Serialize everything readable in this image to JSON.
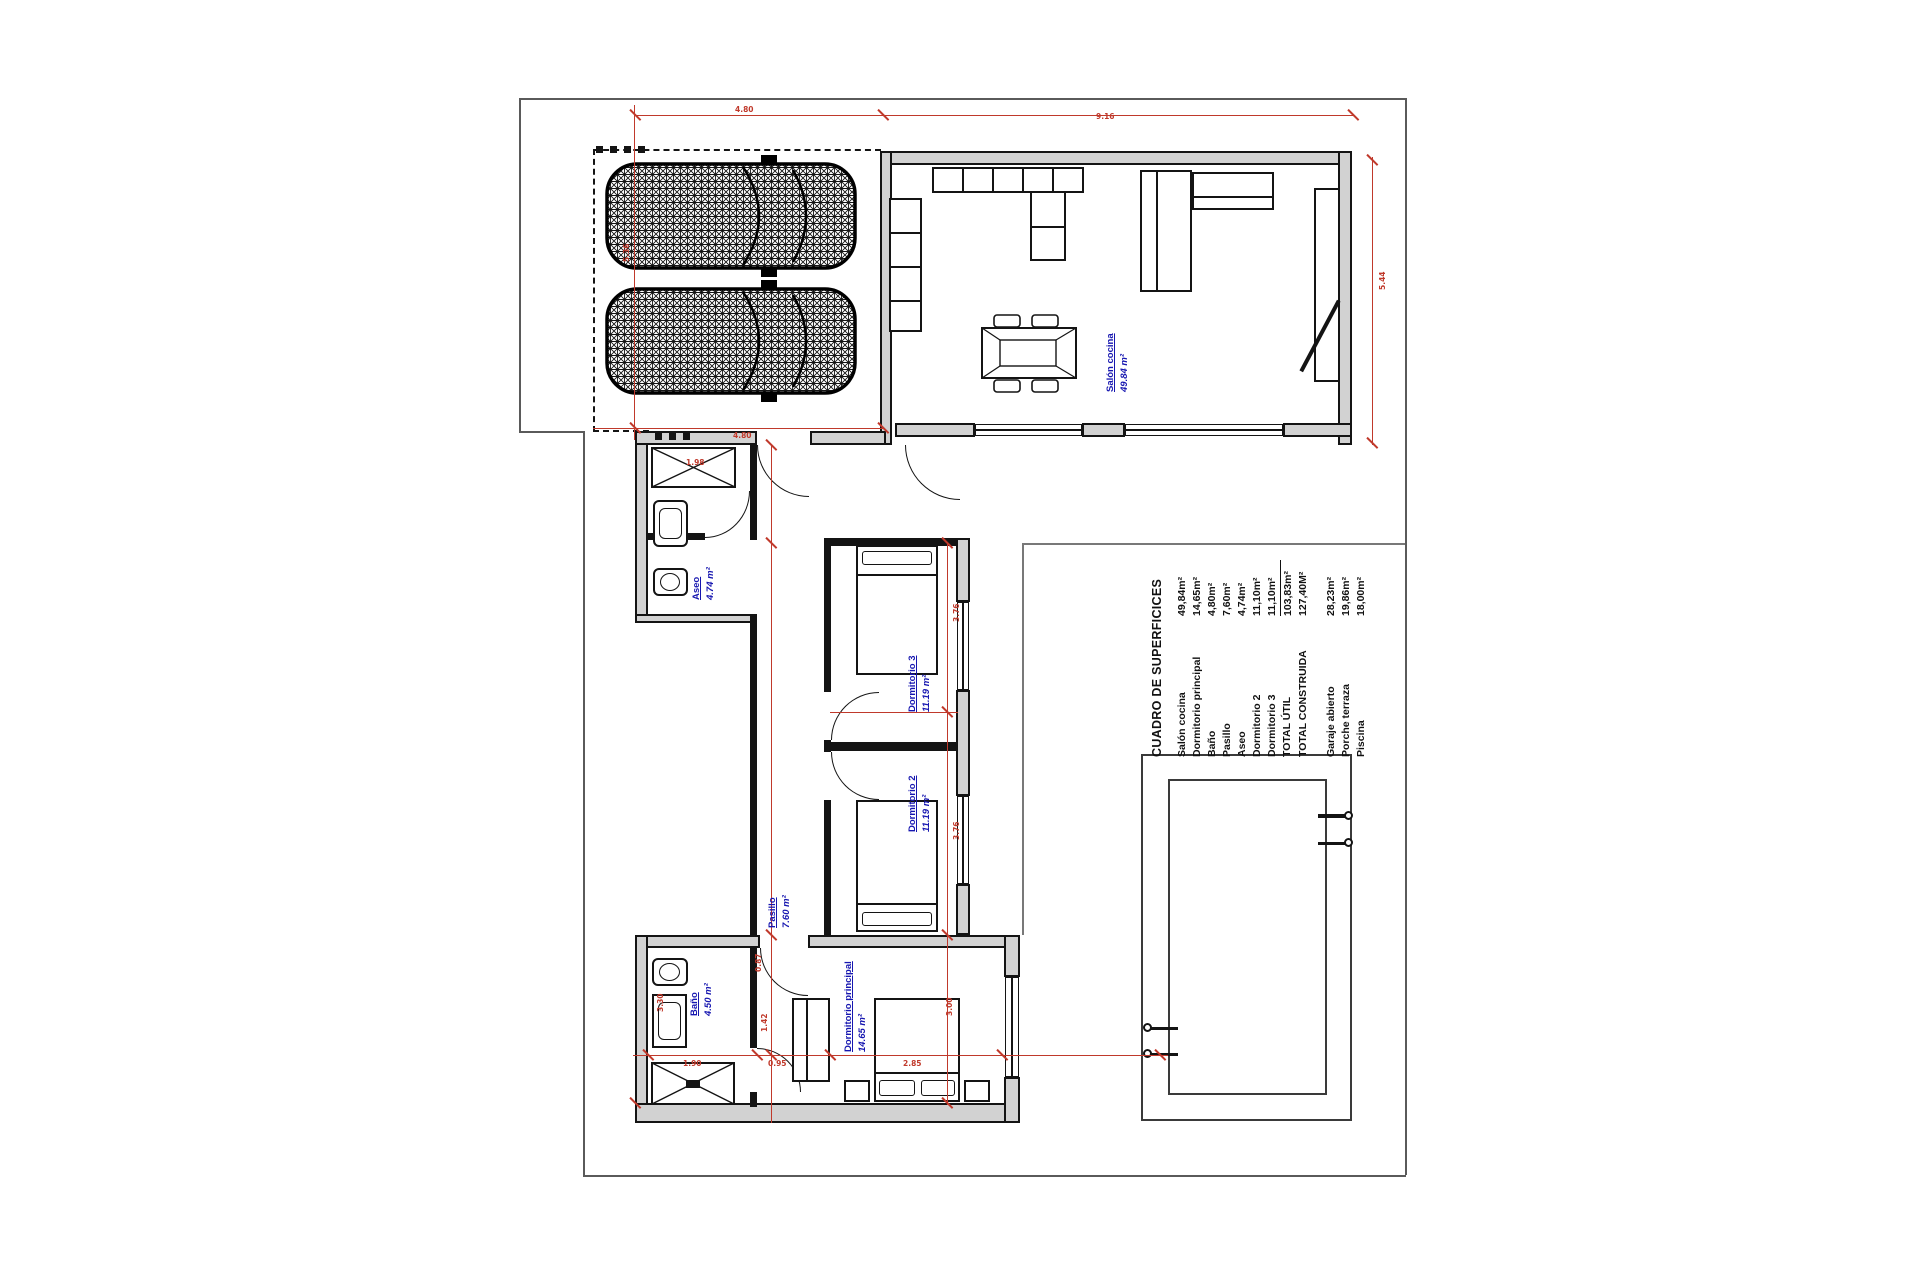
{
  "colors": {
    "red": "#c0392b",
    "blue": "#1616b0",
    "wall_fill": "#d2d2d2",
    "line": "#141414"
  },
  "surface_table": {
    "header": "CUADRO DE SUPERFICICES",
    "rows": [
      {
        "label": "Salón cocina",
        "value": "49,84m²"
      },
      {
        "label": "Dormitorio principal",
        "value": "14,65m²"
      },
      {
        "label": "Baño",
        "value": "4,80m²"
      },
      {
        "label": "Pasillo",
        "value": "7,60m²"
      },
      {
        "label": "Aseo",
        "value": "4,74m²"
      },
      {
        "label": "Dormitorio 2",
        "value": "11,10m²"
      },
      {
        "label": "Dormitorio 3",
        "value": "11,10m²"
      },
      {
        "label": "TOTAL ÚTIL",
        "value": "103,83m²"
      },
      {
        "label": "TOTAL CONSTRUIDA",
        "value": "127,40M²"
      }
    ],
    "extra_rows": [
      {
        "label": "Garaje abierto",
        "value": "28,23m²"
      },
      {
        "label": "Porche terraza",
        "value": "19,86m²"
      },
      {
        "label": "Piscina",
        "value": "18,00m²"
      }
    ]
  },
  "room_labels": {
    "salon": {
      "name": "Salón cocina",
      "area": "49.84 m²"
    },
    "aseo": {
      "name": "Aseo",
      "area": "4.74 m²"
    },
    "dormitorio3": {
      "name": "Dormitorio 3",
      "area": "11.19 m²"
    },
    "dormitorio2": {
      "name": "Dormitorio 2",
      "area": "11.19 m²"
    },
    "pasillo": {
      "name": "Pasillo",
      "area": "7.60 m²"
    },
    "banio": {
      "name": "Baño",
      "area": "4.50 m²"
    },
    "principal": {
      "name": "Dormitorio principal",
      "area": "14.65 m²"
    }
  },
  "dimensions": [
    {
      "text": "4.80"
    },
    {
      "text": "9.16"
    },
    {
      "text": "5.36"
    },
    {
      "text": "4.80"
    },
    {
      "text": "1.98"
    },
    {
      "text": "5.44"
    },
    {
      "text": "3.76"
    },
    {
      "text": "3.76"
    },
    {
      "text": "3.00"
    },
    {
      "text": "3.30"
    },
    {
      "text": "0.87"
    },
    {
      "text": "1.42"
    },
    {
      "text": "1.90"
    },
    {
      "text": "0.95"
    },
    {
      "text": "2.85"
    }
  ]
}
